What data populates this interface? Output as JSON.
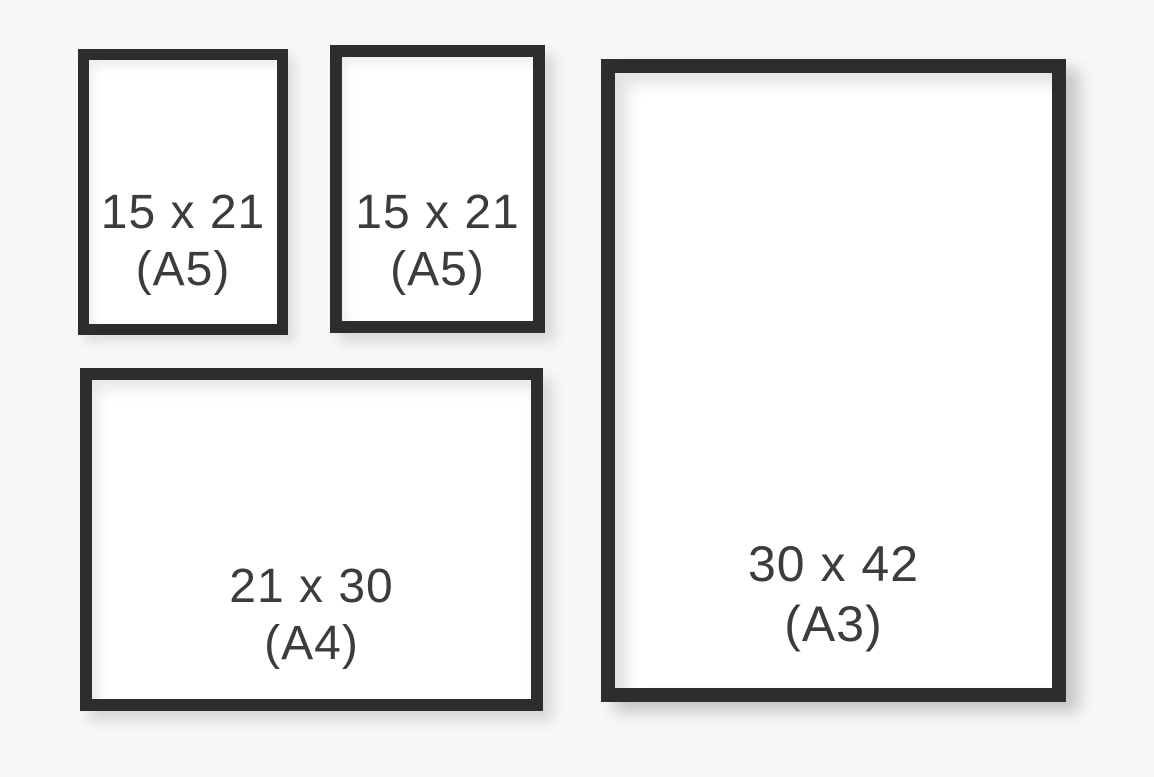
{
  "colors": {
    "background": "#f7f7f5",
    "frame": "#2d2d2d",
    "paper": "#ffffff",
    "text": "#3c3c3c"
  },
  "frames": [
    {
      "name": "a5-top-left",
      "size_label": "15 x 21",
      "format_label": "(A5)"
    },
    {
      "name": "a5-top-middle",
      "size_label": "15 x 21",
      "format_label": "(A5)"
    },
    {
      "name": "a4-landscape",
      "size_label": "21 x 30",
      "format_label": "(A4)"
    },
    {
      "name": "a3-portrait",
      "size_label": "30 x 42",
      "format_label": "(A3)"
    }
  ]
}
